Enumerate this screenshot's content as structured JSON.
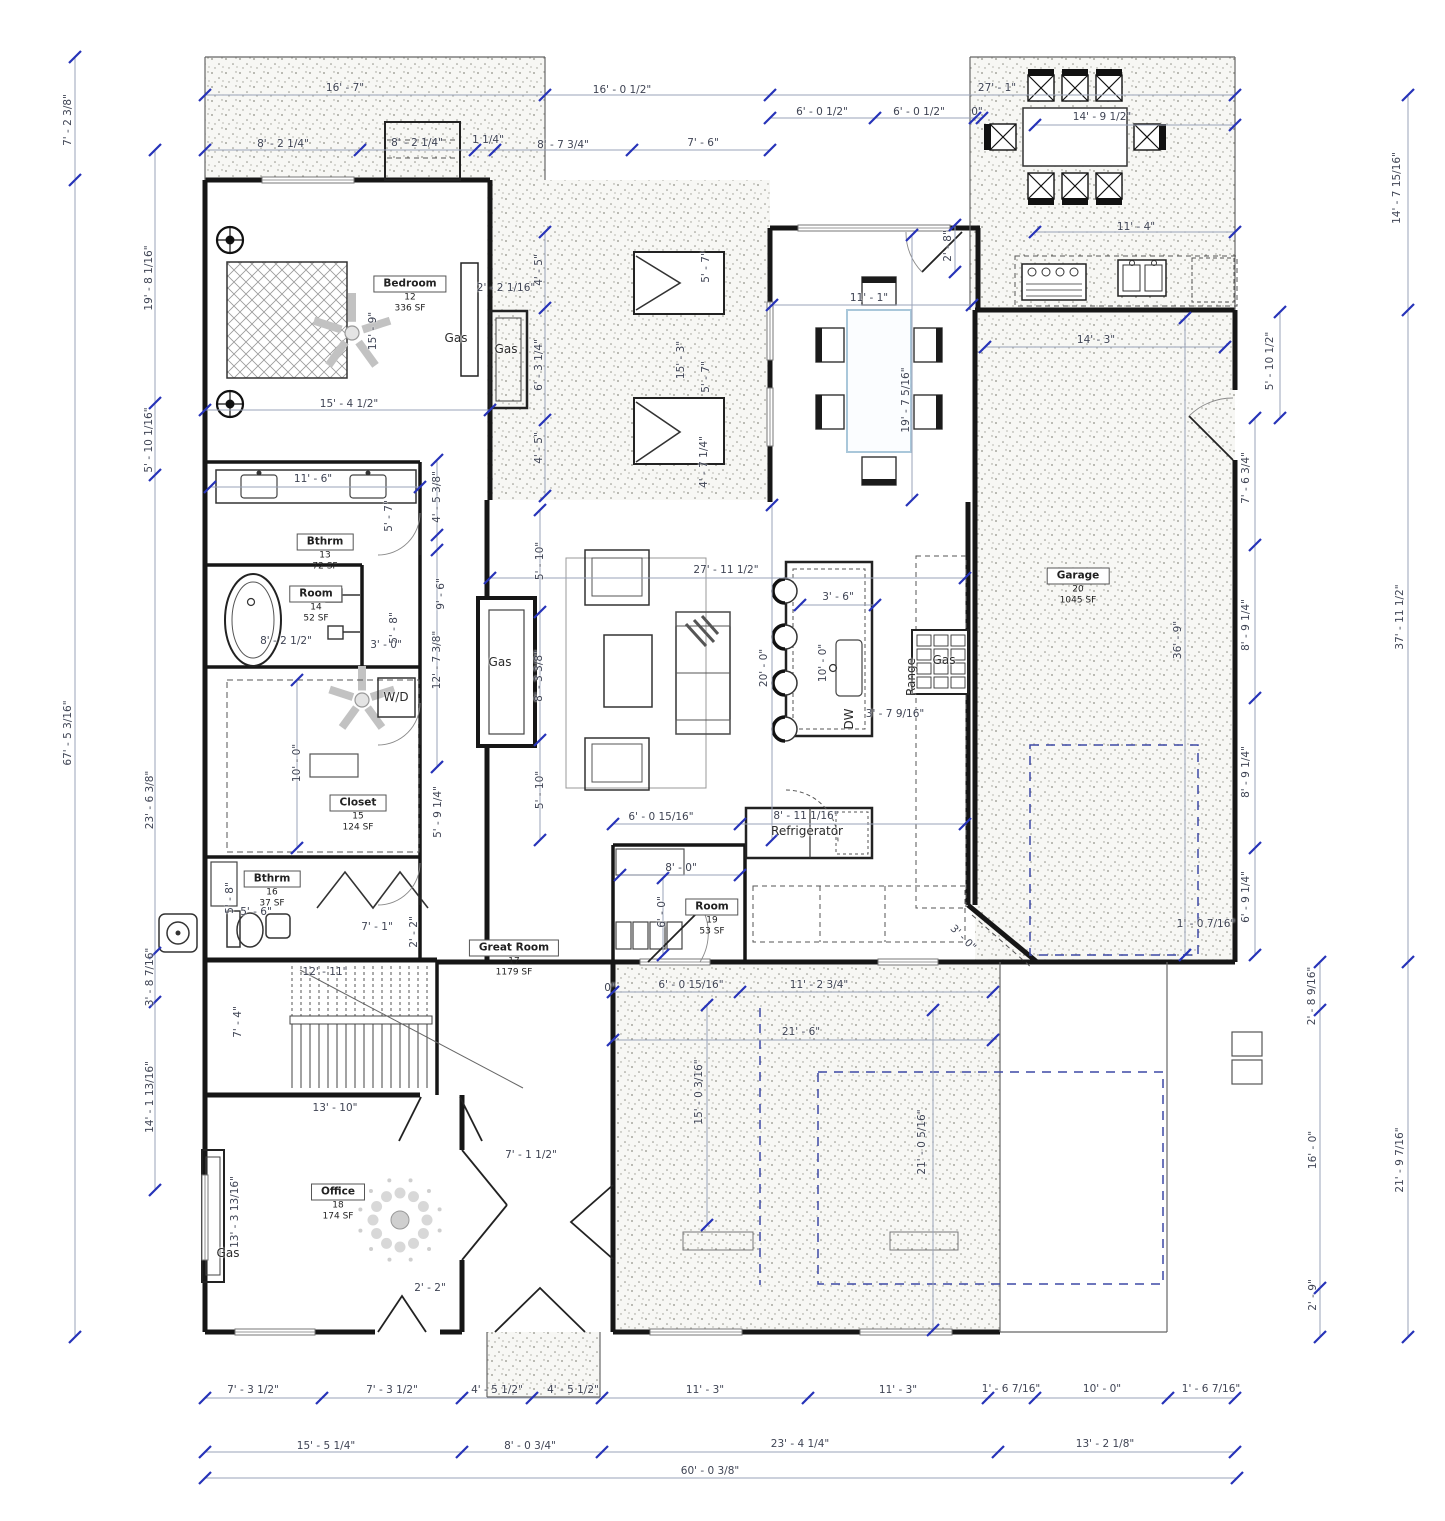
{
  "drawing": {
    "type": "residential floor plan"
  },
  "colors": {
    "wall": "#161616",
    "dim_line": "#9aa3b8",
    "dim_text": "#3f4454",
    "tick": "#2633b8",
    "dashed_navy": "#3d49a5",
    "stipple_dot": "#8f8f85",
    "furniture": "#3a3a3a",
    "table_accent": "#a9c7da"
  },
  "rooms": [
    {
      "name": "Bedroom",
      "number": "12",
      "area": "336 SF",
      "x": 410,
      "y": 293
    },
    {
      "name": "Bthrm",
      "number": "13",
      "area": "72 SF",
      "x": 325,
      "y": 551
    },
    {
      "name": "Room",
      "number": "14",
      "area": "52 SF",
      "x": 316,
      "y": 603
    },
    {
      "name": "Closet",
      "number": "15",
      "area": "124 SF",
      "x": 358,
      "y": 812
    },
    {
      "name": "Bthrm",
      "number": "16",
      "area": "37 SF",
      "x": 272,
      "y": 888
    },
    {
      "name": "Great Room",
      "number": "17",
      "area": "1179 SF",
      "x": 514,
      "y": 957
    },
    {
      "name": "Office",
      "number": "18",
      "area": "174 SF",
      "x": 338,
      "y": 1201
    },
    {
      "name": "Room",
      "number": "19",
      "area": "53 SF",
      "x": 712,
      "y": 916
    },
    {
      "name": "Garage",
      "number": "20",
      "area": "1045 SF",
      "x": 1078,
      "y": 585
    }
  ],
  "labels": [
    {
      "t": "16' - 7\"",
      "x": 345,
      "y": 88
    },
    {
      "t": "16' - 0 1/2\"",
      "x": 622,
      "y": 90
    },
    {
      "t": "27' - 1\"",
      "x": 997,
      "y": 88
    },
    {
      "t": "8' - 2 1/4\"",
      "x": 283,
      "y": 144
    },
    {
      "t": "8' - 2 1/4\"",
      "x": 417,
      "y": 143
    },
    {
      "t": "1 1/4\"",
      "x": 488,
      "y": 140
    },
    {
      "t": "8' - 7 3/4\"",
      "x": 563,
      "y": 145
    },
    {
      "t": "7' - 6\"",
      "x": 703,
      "y": 143
    },
    {
      "t": "6' - 0 1/2\"",
      "x": 822,
      "y": 112
    },
    {
      "t": "6' - 0 1/2\"",
      "x": 919,
      "y": 112
    },
    {
      "t": "0\"",
      "x": 977,
      "y": 112
    },
    {
      "t": "14' - 9 1/2\"",
      "x": 1102,
      "y": 117
    },
    {
      "t": "11' - 4\"",
      "x": 1136,
      "y": 227
    },
    {
      "t": "11' - 1\"",
      "x": 869,
      "y": 298
    },
    {
      "t": "2' - 2 1/16\"",
      "x": 506,
      "y": 288
    },
    {
      "t": "15' - 4 1/2\"",
      "x": 349,
      "y": 404
    },
    {
      "t": "14' - 3\"",
      "x": 1096,
      "y": 340
    },
    {
      "t": "11' - 6\"",
      "x": 313,
      "y": 479
    },
    {
      "t": "27' - 11 1/2\"",
      "x": 726,
      "y": 570
    },
    {
      "t": "3' - 6\"",
      "x": 838,
      "y": 597
    },
    {
      "t": "8' - 2 1/2\"",
      "x": 286,
      "y": 641
    },
    {
      "t": "3' - 0\"",
      "x": 386,
      "y": 645
    },
    {
      "t": "3' - 7 9/16\"",
      "x": 895,
      "y": 714
    },
    {
      "t": "6' - 0 15/16\"",
      "x": 661,
      "y": 817
    },
    {
      "t": "8' - 11 1/16\"",
      "x": 806,
      "y": 816
    },
    {
      "t": "8' - 0\"",
      "x": 681,
      "y": 868
    },
    {
      "t": "5' - 6\"",
      "x": 256,
      "y": 912
    },
    {
      "t": "7' - 1\"",
      "x": 377,
      "y": 927
    },
    {
      "t": "1' - 0 7/16\"",
      "x": 1206,
      "y": 924
    },
    {
      "t": "0\"",
      "x": 610,
      "y": 988
    },
    {
      "t": "6' - 0 15/16\"",
      "x": 691,
      "y": 985
    },
    {
      "t": "11' - 2 3/4\"",
      "x": 819,
      "y": 985
    },
    {
      "t": "21' - 6\"",
      "x": 801,
      "y": 1032
    },
    {
      "t": "12' - 11\"",
      "x": 325,
      "y": 972
    },
    {
      "t": "13' - 10\"",
      "x": 335,
      "y": 1108
    },
    {
      "t": "7' - 1 1/2\"",
      "x": 531,
      "y": 1155
    },
    {
      "t": "2' - 2\"",
      "x": 430,
      "y": 1288
    },
    {
      "t": "7' - 3 1/2\"",
      "x": 253,
      "y": 1390
    },
    {
      "t": "7' - 3 1/2\"",
      "x": 392,
      "y": 1390
    },
    {
      "t": "4' - 5 1/2\"",
      "x": 497,
      "y": 1390
    },
    {
      "t": "4' - 5 1/2\"",
      "x": 573,
      "y": 1390
    },
    {
      "t": "11' - 3\"",
      "x": 705,
      "y": 1390
    },
    {
      "t": "11' - 3\"",
      "x": 898,
      "y": 1390
    },
    {
      "t": "1' - 6 7/16\"",
      "x": 1011,
      "y": 1389
    },
    {
      "t": "10' - 0\"",
      "x": 1102,
      "y": 1389
    },
    {
      "t": "1' - 6 7/16\"",
      "x": 1211,
      "y": 1389
    },
    {
      "t": "15' - 5 1/4\"",
      "x": 326,
      "y": 1446
    },
    {
      "t": "8' - 0 3/4\"",
      "x": 530,
      "y": 1446
    },
    {
      "t": "23' - 4 1/4\"",
      "x": 800,
      "y": 1444
    },
    {
      "t": "13' - 2 1/8\"",
      "x": 1105,
      "y": 1444
    },
    {
      "t": "60' - 0 3/8\"",
      "x": 710,
      "y": 1471
    },
    {
      "t": "7' - 2 3/8\"",
      "x": 68,
      "y": 120,
      "r": "v"
    },
    {
      "t": "19' - 8 1/16\"",
      "x": 149,
      "y": 278,
      "r": "v"
    },
    {
      "t": "5' - 10 1/16\"",
      "x": 149,
      "y": 440,
      "r": "v"
    },
    {
      "t": "67' - 5 3/16\"",
      "x": 68,
      "y": 733,
      "r": "v"
    },
    {
      "t": "23' - 6 3/8\"",
      "x": 150,
      "y": 800,
      "r": "v"
    },
    {
      "t": "3' - 8 7/16\"",
      "x": 150,
      "y": 977,
      "r": "v"
    },
    {
      "t": "14' - 1 13/16\"",
      "x": 150,
      "y": 1097,
      "r": "v"
    },
    {
      "t": "14' - 7 15/16\"",
      "x": 1397,
      "y": 188,
      "r": "v"
    },
    {
      "t": "37' - 11 1/2\"",
      "x": 1400,
      "y": 617,
      "r": "v"
    },
    {
      "t": "21' - 9 7/16\"",
      "x": 1400,
      "y": 1160,
      "r": "v"
    },
    {
      "t": "5' - 10 1/2\"",
      "x": 1270,
      "y": 361,
      "r": "v"
    },
    {
      "t": "7' - 6 3/4\"",
      "x": 1246,
      "y": 478,
      "r": "v"
    },
    {
      "t": "8' - 9 1/4\"",
      "x": 1246,
      "y": 625,
      "r": "v"
    },
    {
      "t": "8' - 9 1/4\"",
      "x": 1246,
      "y": 772,
      "r": "v"
    },
    {
      "t": "6' - 9 1/4\"",
      "x": 1246,
      "y": 897,
      "r": "v"
    },
    {
      "t": "2' - 8 9/16\"",
      "x": 1312,
      "y": 996,
      "r": "v"
    },
    {
      "t": "16' - 0\"",
      "x": 1313,
      "y": 1150,
      "r": "v"
    },
    {
      "t": "2' - 9\"",
      "x": 1313,
      "y": 1295,
      "r": "v"
    },
    {
      "t": "36' - 9\"",
      "x": 1178,
      "y": 640,
      "r": "v"
    },
    {
      "t": "2' - 8\"",
      "x": 948,
      "y": 246,
      "r": "v"
    },
    {
      "t": "19' - 7 5/16\"",
      "x": 906,
      "y": 400,
      "r": "v"
    },
    {
      "t": "4' - 5\"",
      "x": 539,
      "y": 270,
      "r": "v"
    },
    {
      "t": "6' - 3 1/4\"",
      "x": 539,
      "y": 365,
      "r": "v"
    },
    {
      "t": "4' - 5\"",
      "x": 539,
      "y": 448,
      "r": "v"
    },
    {
      "t": "15' - 9\"",
      "x": 373,
      "y": 331,
      "r": "v"
    },
    {
      "t": "5' - 7\"",
      "x": 706,
      "y": 267,
      "r": "v"
    },
    {
      "t": "15' - 3\"",
      "x": 681,
      "y": 360,
      "r": "v"
    },
    {
      "t": "5' - 7\"",
      "x": 706,
      "y": 377,
      "r": "v"
    },
    {
      "t": "4' - 7 1/4\"",
      "x": 704,
      "y": 462,
      "r": "v"
    },
    {
      "t": "4' - 5 3/8\"",
      "x": 437,
      "y": 497,
      "r": "v"
    },
    {
      "t": "5' - 7\"",
      "x": 389,
      "y": 516,
      "r": "v"
    },
    {
      "t": "9' - 6\"",
      "x": 441,
      "y": 594,
      "r": "v"
    },
    {
      "t": "5' - 8\"",
      "x": 394,
      "y": 628,
      "r": "v"
    },
    {
      "t": "12' - 7 3/8\"",
      "x": 437,
      "y": 660,
      "r": "v"
    },
    {
      "t": "10' - 0\"",
      "x": 297,
      "y": 763,
      "r": "v"
    },
    {
      "t": "5' - 9 1/4\"",
      "x": 438,
      "y": 812,
      "r": "v"
    },
    {
      "t": "5' - 8\"",
      "x": 230,
      "y": 898,
      "r": "v"
    },
    {
      "t": "2' - 2\"",
      "x": 414,
      "y": 932,
      "r": "v"
    },
    {
      "t": "7' - 4\"",
      "x": 238,
      "y": 1022,
      "r": "v"
    },
    {
      "t": "13' - 3 13/16\"",
      "x": 235,
      "y": 1212,
      "r": "v"
    },
    {
      "t": "5' - 10\"",
      "x": 540,
      "y": 561,
      "r": "v"
    },
    {
      "t": "8' - 3 3/8\"",
      "x": 539,
      "y": 676,
      "r": "v"
    },
    {
      "t": "5' - 10\"",
      "x": 540,
      "y": 790,
      "r": "v"
    },
    {
      "t": "20' - 0\"",
      "x": 764,
      "y": 668,
      "r": "v"
    },
    {
      "t": "10' - 0\"",
      "x": 823,
      "y": 663,
      "r": "v"
    },
    {
      "t": "21' - 0 5/16\"",
      "x": 922,
      "y": 1142,
      "r": "v"
    },
    {
      "t": "15' - 0 3/16\"",
      "x": 699,
      "y": 1092,
      "r": "v"
    },
    {
      "t": "6' - 0\"",
      "x": 662,
      "y": 912,
      "r": "v"
    },
    {
      "t": "3' - 0\"",
      "x": 963,
      "y": 938,
      "r": "d"
    },
    {
      "t": "Gas",
      "x": 456,
      "y": 338,
      "k": "a"
    },
    {
      "t": "Gas",
      "x": 506,
      "y": 349,
      "k": "a"
    },
    {
      "t": "Gas",
      "x": 500,
      "y": 662,
      "k": "a"
    },
    {
      "t": "Gas",
      "x": 944,
      "y": 660,
      "k": "a"
    },
    {
      "t": "Gas",
      "x": 228,
      "y": 1253,
      "k": "a"
    },
    {
      "t": "W/D",
      "x": 396,
      "y": 697,
      "k": "a"
    },
    {
      "t": "DW",
      "x": 849,
      "y": 719,
      "k": "a",
      "r": "v"
    },
    {
      "t": "Range",
      "x": 911,
      "y": 677,
      "k": "a",
      "r": "v"
    },
    {
      "t": "Refrigerator",
      "x": 807,
      "y": 831,
      "k": "a"
    }
  ]
}
